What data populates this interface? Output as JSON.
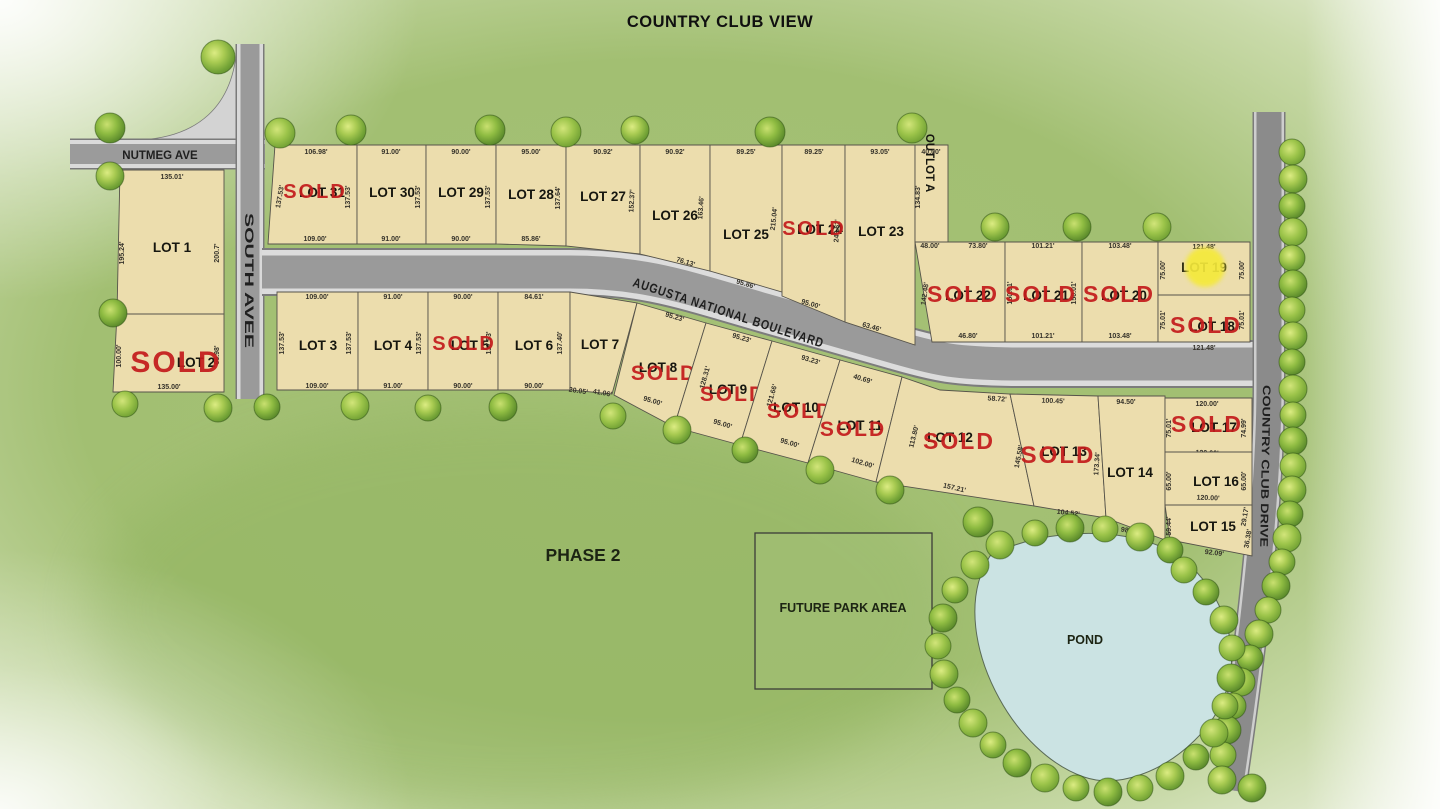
{
  "title": "COUNTRY CLUB VIEW",
  "phase_label": "PHASE 2",
  "sold_stamp": "SOLD",
  "roads": {
    "nutmeg": "NUTMEG AVE",
    "south": "SOUTH AVEE",
    "augusta": "AUGUSTA NATIONAL BOULEVARD",
    "country_club": "COUNTRY CLUB DRIVE"
  },
  "areas": {
    "future_park": "FUTURE PARK AREA",
    "pond": "POND"
  },
  "colors": {
    "lot_fill": "#ecddad",
    "lot_stroke": "#56534a",
    "sold_red": "#c41c1c",
    "road_core": "#9b9b9b",
    "road_casing": "#dadada",
    "water": "#cbe3e3",
    "highlight_yellow": "#f4e93b",
    "background_green": "#a6c277"
  },
  "marker": {
    "lot": "LOT 19",
    "x": 1205,
    "y": 267,
    "r": 20
  },
  "lots": [
    {
      "id": "lot-1",
      "label": "LOT 1",
      "sold": false,
      "poly": "120,170 224,170 224,314 117,314",
      "lx": 172,
      "ly": 252,
      "dims": [
        [
          "135.01'",
          172,
          179,
          0
        ],
        [
          "195.24'",
          124,
          253,
          -90
        ],
        [
          "200.7'",
          219,
          253,
          -90
        ],
        [
          "135.04'",
          171,
          321,
          0
        ]
      ]
    },
    {
      "id": "lot-2",
      "label": "LOT 2",
      "sold": true,
      "poly": "117,314 224,314 224,392 113,392",
      "lx": 196,
      "ly": 367,
      "sx": 176,
      "sy": 372,
      "ss": 30,
      "dims": [
        [
          "100.00'",
          121,
          356,
          -90
        ],
        [
          "66.98'",
          219,
          355,
          -90
        ],
        [
          "135.00'",
          169,
          389,
          0
        ]
      ]
    },
    {
      "id": "lot-31",
      "label": "LOT 31",
      "sold": true,
      "poly": "275,145 357,145 357,244 268,244",
      "lx": 322,
      "ly": 197,
      "sx": 315,
      "sy": 198,
      "ss": 20,
      "dims": [
        [
          "106.98'",
          316,
          154,
          0
        ],
        [
          "137.53'",
          282,
          197,
          -80
        ],
        [
          "137.53'",
          350,
          197,
          -90
        ],
        [
          "109.00'",
          315,
          241,
          0
        ]
      ]
    },
    {
      "id": "lot-30",
      "label": "LOT 30",
      "sold": false,
      "poly": "357,145 426,145 426,244 357,244",
      "lx": 392,
      "ly": 197,
      "dims": [
        [
          "91.00'",
          391,
          154,
          0
        ],
        [
          "137.53'",
          420,
          197,
          -90
        ],
        [
          "91.00'",
          391,
          241,
          0
        ]
      ]
    },
    {
      "id": "lot-29",
      "label": "LOT 29",
      "sold": false,
      "poly": "426,145 496,145 496,244 426,244",
      "lx": 461,
      "ly": 197,
      "dims": [
        [
          "90.00'",
          461,
          154,
          0
        ],
        [
          "137.53'",
          490,
          197,
          -90
        ],
        [
          "90.00'",
          461,
          241,
          0
        ]
      ]
    },
    {
      "id": "lot-28",
      "label": "LOT 28",
      "sold": false,
      "poly": "496,145 566,145 566,246 496,244",
      "lx": 531,
      "ly": 199,
      "dims": [
        [
          "95.00'",
          531,
          154,
          0
        ],
        [
          "137.64'",
          560,
          198,
          -90
        ],
        [
          "85.86'",
          531,
          241,
          0
        ]
      ]
    },
    {
      "id": "lot-27",
      "label": "LOT 27",
      "sold": false,
      "poly": "566,145 640,145 640,254 566,246",
      "lx": 603,
      "ly": 201,
      "dims": [
        [
          "90.92'",
          603,
          154,
          0
        ],
        [
          "152.37'",
          634,
          201,
          -87
        ]
      ]
    },
    {
      "id": "lot-26",
      "label": "LOT 26",
      "sold": false,
      "poly": "640,145 710,145 710,271 640,254",
      "lx": 675,
      "ly": 220,
      "dims": [
        [
          "90.92'",
          675,
          154,
          0
        ],
        [
          "163.46'",
          703,
          208,
          -86
        ],
        [
          "76.13'",
          685,
          264,
          17
        ]
      ]
    },
    {
      "id": "lot-25",
      "label": "LOT 25",
      "sold": false,
      "poly": "710,145 782,145 782,292 710,271",
      "lx": 746,
      "ly": 239,
      "dims": [
        [
          "89.25'",
          746,
          154,
          0
        ],
        [
          "215.04'",
          776,
          219,
          -84
        ],
        [
          "95.86'",
          745,
          286,
          17
        ]
      ]
    },
    {
      "id": "lot-24",
      "label": "LOT 24",
      "sold": true,
      "poly": "782,145 845,145 845,322 782,296",
      "lx": 820,
      "ly": 234,
      "sx": 814,
      "sy": 235,
      "ss": 20,
      "dims": [
        [
          "89.25'",
          814,
          154,
          0
        ],
        [
          "248.62'",
          839,
          231,
          -87
        ],
        [
          "95.00'",
          810,
          306,
          17
        ]
      ]
    },
    {
      "id": "lot-23",
      "label": "LOT 23",
      "sold": false,
      "poly": "845,145 915,145 915,345 845,322",
      "lx": 881,
      "ly": 236,
      "dims": [
        [
          "93.05'",
          880,
          154,
          0
        ],
        [
          "63.46'",
          871,
          329,
          17
        ]
      ]
    },
    {
      "id": "outlot-a",
      "label": "OUTLOT A",
      "sold": false,
      "poly": "915,145 948,145 948,242 915,242",
      "lx": 926,
      "ly": 163,
      "lr": 90,
      "ls": 11.5,
      "dims": [
        [
          "40.00'",
          931,
          154,
          0
        ],
        [
          "134.83'",
          920,
          197,
          -90
        ]
      ]
    },
    {
      "id": "lot-22",
      "label": "LOT 22",
      "sold": true,
      "poly": "915,242 1005,242 1005,342 932,342",
      "lx": 968,
      "ly": 300,
      "sx": 963,
      "sy": 302,
      "ss": 23,
      "dims": [
        [
          "48.00'",
          930,
          248,
          0
        ],
        [
          "73.80'",
          978,
          248,
          0
        ],
        [
          "142.48'",
          927,
          294,
          -82
        ],
        [
          "46.80'",
          968,
          338,
          0
        ]
      ]
    },
    {
      "id": "lot-21",
      "label": "LOT 21",
      "sold": true,
      "poly": "1005,242 1082,242 1082,342 1005,342",
      "lx": 1046,
      "ly": 300,
      "sx": 1041,
      "sy": 302,
      "ss": 23,
      "dims": [
        [
          "101.21'",
          1043,
          248,
          0
        ],
        [
          "150.01'",
          1012,
          293,
          -90
        ],
        [
          "150.01'",
          1076,
          293,
          -90
        ],
        [
          "101.21'",
          1043,
          338,
          0
        ]
      ]
    },
    {
      "id": "lot-20",
      "label": "LOT 20",
      "sold": true,
      "poly": "1082,242 1158,242 1158,342 1082,342",
      "lx": 1124,
      "ly": 300,
      "sx": 1119,
      "sy": 302,
      "ss": 23,
      "dims": [
        [
          "103.48'",
          1120,
          248,
          0
        ],
        [
          "103.48'",
          1120,
          338,
          0
        ]
      ]
    },
    {
      "id": "lot-19",
      "label": "LOT 19",
      "sold": false,
      "poly": "1158,242 1250,242 1250,295 1158,295",
      "lx": 1204,
      "ly": 272,
      "dims": [
        [
          "121.48'",
          1204,
          249,
          0
        ],
        [
          "75.00'",
          1165,
          270,
          -90
        ],
        [
          "75.00'",
          1244,
          270,
          -90
        ],
        [
          "121.48'",
          1204,
          302,
          0
        ]
      ]
    },
    {
      "id": "lot-18",
      "label": "LOT 18",
      "sold": true,
      "poly": "1158,295 1250,295 1250,342 1158,342",
      "lx": 1212,
      "ly": 331,
      "sx": 1206,
      "sy": 333,
      "ss": 23,
      "dims": [
        [
          "75.01'",
          1165,
          320,
          -90
        ],
        [
          "75.01'",
          1244,
          320,
          -90
        ],
        [
          "121.48'",
          1204,
          350,
          0
        ]
      ]
    },
    {
      "id": "lot-3",
      "label": "LOT 3",
      "sold": false,
      "poly": "277,292 358,292 358,390 277,390",
      "lx": 318,
      "ly": 350,
      "dims": [
        [
          "109.00'",
          317,
          299,
          0
        ],
        [
          "137.53'",
          284,
          343,
          -90
        ],
        [
          "137.53'",
          351,
          343,
          -90
        ],
        [
          "109.00'",
          317,
          388,
          0
        ]
      ]
    },
    {
      "id": "lot-4",
      "label": "LOT 4",
      "sold": false,
      "poly": "358,292 428,292 428,390 358,390",
      "lx": 393,
      "ly": 350,
      "dims": [
        [
          "91.00'",
          393,
          299,
          0
        ],
        [
          "137.53'",
          421,
          343,
          -90
        ],
        [
          "91.00'",
          393,
          388,
          0
        ]
      ]
    },
    {
      "id": "lot-5",
      "label": "LOT 5",
      "sold": true,
      "poly": "428,292 498,292 498,390 428,390",
      "lx": 470,
      "ly": 350,
      "sx": 464,
      "sy": 350,
      "ss": 20,
      "dims": [
        [
          "90.00'",
          463,
          299,
          0
        ],
        [
          "137.53'",
          491,
          343,
          -90
        ],
        [
          "90.00'",
          463,
          388,
          0
        ]
      ]
    },
    {
      "id": "lot-6",
      "label": "LOT 6",
      "sold": false,
      "poly": "498,292 570,292 570,390 498,390",
      "lx": 534,
      "ly": 350,
      "dims": [
        [
          "84.61'",
          534,
          299,
          0
        ],
        [
          "137.40'",
          562,
          343,
          -90
        ],
        [
          "90.00'",
          534,
          388,
          0
        ]
      ]
    },
    {
      "id": "lot-7",
      "label": "LOT 7",
      "sold": false,
      "poly": "570,292 637,303 612,394 570,390",
      "lx": 600,
      "ly": 349,
      "dims": [
        [
          "20.05'",
          578,
          393,
          8
        ],
        [
          "41.06'",
          602,
          395,
          10
        ],
        [
          "134.97'",
          630,
          353,
          -78
        ]
      ]
    },
    {
      "id": "lot-8",
      "label": "LOT 8",
      "sold": true,
      "poly": "637,303 706,323 674,427 614,395",
      "lx": 658,
      "ly": 372,
      "sx": 664,
      "sy": 380,
      "ss": 21,
      "dims": [
        [
          "95.23'",
          674,
          319,
          17
        ],
        [
          "95.00'",
          652,
          403,
          17
        ]
      ]
    },
    {
      "id": "lot-9",
      "label": "LOT 9",
      "sold": true,
      "poly": "706,323 772,341 740,445 674,427",
      "lx": 728,
      "ly": 394,
      "sx": 733,
      "sy": 401,
      "ss": 21,
      "dims": [
        [
          "95.23'",
          741,
          340,
          17
        ],
        [
          "128.31'",
          707,
          378,
          -74
        ],
        [
          "95.00'",
          722,
          426,
          17
        ]
      ]
    },
    {
      "id": "lot-10",
      "label": "LOT 10",
      "sold": true,
      "poly": "772,341 840,360 808,463 740,445",
      "lx": 796,
      "ly": 412,
      "sx": 800,
      "sy": 418,
      "ss": 21,
      "dims": [
        [
          "93.23'",
          810,
          362,
          17
        ],
        [
          "121.66'",
          774,
          396,
          -74
        ],
        [
          "95.00'",
          789,
          445,
          17
        ]
      ]
    },
    {
      "id": "lot-11",
      "label": "LOT 11",
      "sold": true,
      "poly": "840,360 902,377 876,482 808,463",
      "lx": 860,
      "ly": 430,
      "sx": 853,
      "sy": 436,
      "ss": 21,
      "dims": [
        [
          "40.69'",
          862,
          381,
          17
        ],
        [
          "102.00'",
          862,
          465,
          17
        ]
      ]
    },
    {
      "id": "lot-12",
      "label": "LOT 12",
      "sold": true,
      "poly": "902,377 940,390 1010,394 1034,506 876,482",
      "lx": 950,
      "ly": 442,
      "sx": 959,
      "sy": 449,
      "ss": 23,
      "dims": [
        [
          "58.72'",
          997,
          401,
          4
        ],
        [
          "113.80'",
          916,
          437,
          -76
        ],
        [
          "157.21'",
          954,
          490,
          13
        ]
      ]
    },
    {
      "id": "lot-13",
      "label": "LOT 13",
      "sold": true,
      "poly": "1010,394 1098,396 1106,518 1034,506",
      "lx": 1064,
      "ly": 456,
      "sx": 1058,
      "sy": 463,
      "ss": 24,
      "dims": [
        [
          "100.45'",
          1053,
          403,
          2
        ],
        [
          "145.58'",
          1021,
          457,
          -79
        ],
        [
          "173.34'",
          1099,
          464,
          -86
        ],
        [
          "104.52'",
          1068,
          515,
          7
        ]
      ]
    },
    {
      "id": "lot-14",
      "label": "LOT 14",
      "sold": false,
      "poly": "1098,396 1165,396 1165,540 1106,518",
      "lx": 1130,
      "ly": 477,
      "dims": [
        [
          "94.50'",
          1126,
          404,
          0
        ],
        [
          "98.33'",
          1130,
          533,
          10
        ]
      ]
    },
    {
      "id": "lot-17",
      "label": "LOT 17",
      "sold": true,
      "poly": "1165,398 1252,398 1252,452 1165,452",
      "lx": 1214,
      "ly": 432,
      "sx": 1207,
      "sy": 432,
      "ss": 23,
      "dims": [
        [
          "120.00'",
          1207,
          406,
          0
        ],
        [
          "75.01'",
          1171,
          428,
          -90
        ],
        [
          "74.99'",
          1246,
          428,
          -90
        ],
        [
          "120.00'",
          1207,
          455,
          2
        ]
      ]
    },
    {
      "id": "lot-16",
      "label": "LOT 16",
      "sold": false,
      "poly": "1165,452 1252,452 1252,505 1165,505",
      "lx": 1216,
      "ly": 486,
      "dims": [
        [
          "65.00'",
          1171,
          481,
          -90
        ],
        [
          "65.00'",
          1246,
          481,
          -90
        ],
        [
          "120.00'",
          1208,
          500,
          2
        ]
      ]
    },
    {
      "id": "lot-15",
      "label": "LOT 15",
      "sold": false,
      "poly": "1165,505 1252,505 1252,556 1170,540",
      "lx": 1213,
      "ly": 531,
      "dims": [
        [
          "59.44'",
          1171,
          526,
          -90
        ],
        [
          "7.04'",
          1177,
          549,
          -50
        ],
        [
          "92.09'",
          1214,
          555,
          7
        ],
        [
          "29.17'",
          1247,
          517,
          -80
        ],
        [
          "36.38'",
          1250,
          539,
          -80
        ]
      ]
    }
  ]
}
